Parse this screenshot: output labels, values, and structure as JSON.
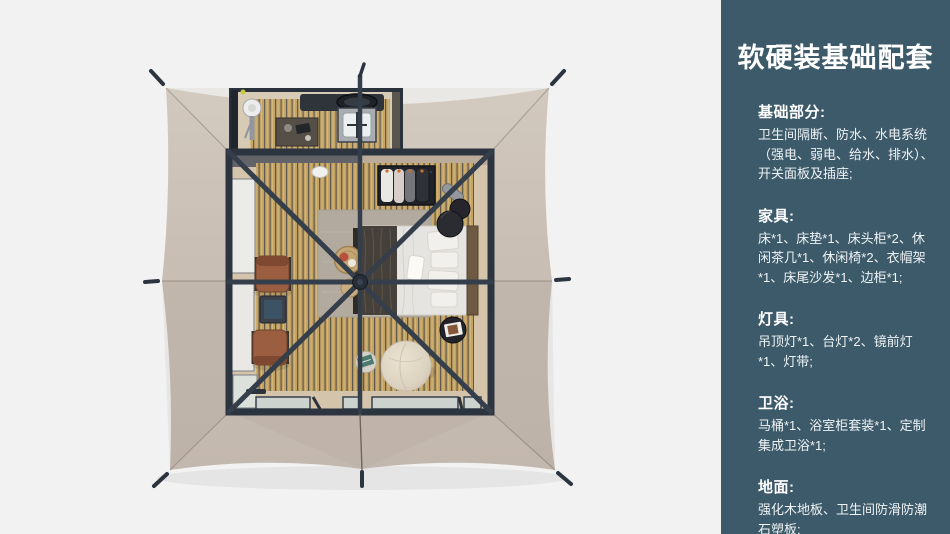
{
  "panel": {
    "title": "软硬装基础配套",
    "sections": [
      {
        "heading": "基础部分:",
        "body": "卫生间隔断、防水、水电系统（强电、弱电、给水、排水）、开关面板及插座;"
      },
      {
        "heading": "家具:",
        "body": "床*1、床垫*1、床头柜*2、休闲茶几*1、休闲椅*2、衣帽架*1、床尾沙发*1、边柜*1;"
      },
      {
        "heading": "灯具:",
        "body": "吊顶灯*1、台灯*2、镜前灯*1、灯带;"
      },
      {
        "heading": "卫浴:",
        "body": "马桶*1、浴室柜套装*1、定制集成卫浴*1;"
      },
      {
        "heading": "地面:",
        "body": "强化木地板、卫生间防滑防潮石塑板;"
      }
    ]
  },
  "colors": {
    "panel_background": "#3d5a6a",
    "panel_text": "#ffffff",
    "page_background": "#f2f2f2",
    "tent_canvas": "#c9beb4",
    "roof_frame": "#2c3440",
    "wood_floor": "#c3a263",
    "rug": "#b3aa9f",
    "lounge_chair": "#9c5e41",
    "pouf": "#dcd2c0"
  }
}
